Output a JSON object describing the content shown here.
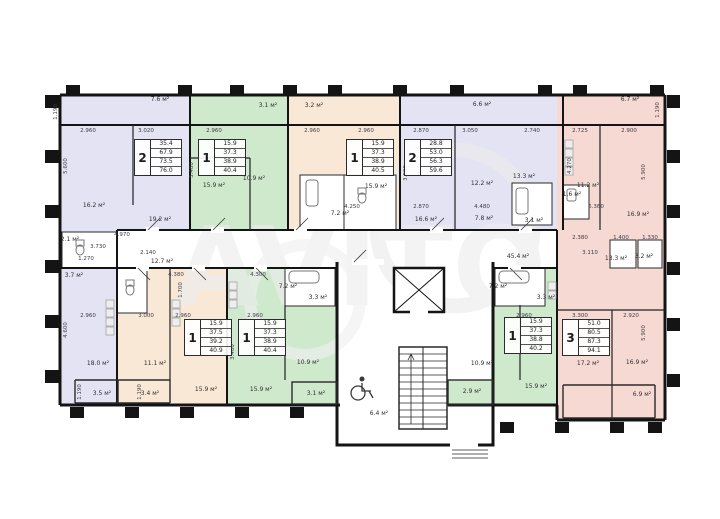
{
  "watermark": {
    "text": "AVITO"
  },
  "colors": {
    "lavender": "#e3e3f4",
    "green": "#cfe9cd",
    "peach": "#fae8d7",
    "pink": "#f7d9d3",
    "wall": "#141414",
    "dim_text": "#3c3c46",
    "watermark": "#ededed"
  },
  "apartments": [
    {
      "num": "2",
      "values": [
        "35.4",
        "67.9",
        "73.5",
        "76.0"
      ],
      "x": 134,
      "y": 139
    },
    {
      "num": "1",
      "values": [
        "15.9",
        "37.3",
        "38.9",
        "40.4"
      ],
      "x": 198,
      "y": 139
    },
    {
      "num": "1",
      "values": [
        "15.9",
        "37.3",
        "38.9",
        "40.5"
      ],
      "x": 346,
      "y": 139
    },
    {
      "num": "2",
      "values": [
        "28.8",
        "53.0",
        "56.3",
        "59.6"
      ],
      "x": 404,
      "y": 139
    },
    {
      "num": "1",
      "values": [
        "15.9",
        "37.5",
        "39.2",
        "40.9"
      ],
      "x": 184,
      "y": 319
    },
    {
      "num": "1",
      "values": [
        "15.9",
        "37.3",
        "38.9",
        "40.4"
      ],
      "x": 238,
      "y": 319
    },
    {
      "num": "1",
      "values": [
        "15.9",
        "37.3",
        "38.8",
        "40.2"
      ],
      "x": 504,
      "y": 317
    },
    {
      "num": "3",
      "values": [
        "51.0",
        "80.5",
        "87.3",
        "94.1"
      ],
      "x": 562,
      "y": 319
    }
  ],
  "area_labels": [
    {
      "t": "7.6 м²",
      "x": 160,
      "y": 100
    },
    {
      "t": "3.1 м²",
      "x": 268,
      "y": 106
    },
    {
      "t": "3.2 м²",
      "x": 314,
      "y": 106
    },
    {
      "t": "6.6 м²",
      "x": 482,
      "y": 105
    },
    {
      "t": "6.7 м²",
      "x": 630,
      "y": 100
    },
    {
      "t": "16.2 м²",
      "x": 94,
      "y": 206
    },
    {
      "t": "19.2 м²",
      "x": 160,
      "y": 220
    },
    {
      "t": "15.9 м²",
      "x": 214,
      "y": 186
    },
    {
      "t": "10.9 м²",
      "x": 254,
      "y": 179
    },
    {
      "t": "15.9 м²",
      "x": 376,
      "y": 187
    },
    {
      "t": "7.2 м²",
      "x": 340,
      "y": 214
    },
    {
      "t": "16.6 м²",
      "x": 426,
      "y": 220
    },
    {
      "t": "12.2 м²",
      "x": 482,
      "y": 184
    },
    {
      "t": "13.3 м²",
      "x": 524,
      "y": 177
    },
    {
      "t": "7.8 м²",
      "x": 484,
      "y": 219
    },
    {
      "t": "3.1 м²",
      "x": 534,
      "y": 221
    },
    {
      "t": "1.6 м²",
      "x": 572,
      "y": 195
    },
    {
      "t": "11.2 м²",
      "x": 588,
      "y": 186
    },
    {
      "t": "16.9 м²",
      "x": 638,
      "y": 215
    },
    {
      "t": "45.4 м²",
      "x": 518,
      "y": 257
    },
    {
      "t": "12.7 м²",
      "x": 162,
      "y": 262
    },
    {
      "t": "2.1 м²",
      "x": 70,
      "y": 240
    },
    {
      "t": "3.7 м²",
      "x": 74,
      "y": 276
    },
    {
      "t": "18.0 м²",
      "x": 98,
      "y": 364
    },
    {
      "t": "11.1 м²",
      "x": 155,
      "y": 364
    },
    {
      "t": "3.5 м²",
      "x": 102,
      "y": 394
    },
    {
      "t": "3.4 м²",
      "x": 150,
      "y": 394
    },
    {
      "t": "15.9 м²",
      "x": 206,
      "y": 390
    },
    {
      "t": "15.9 м²",
      "x": 261,
      "y": 390
    },
    {
      "t": "3.1 м²",
      "x": 316,
      "y": 394
    },
    {
      "t": "10.9 м²",
      "x": 308,
      "y": 363
    },
    {
      "t": "7.2 м²",
      "x": 288,
      "y": 287
    },
    {
      "t": "3.3 м²",
      "x": 318,
      "y": 298
    },
    {
      "t": "7.2 м²",
      "x": 498,
      "y": 287
    },
    {
      "t": "3.3 м²",
      "x": 546,
      "y": 298
    },
    {
      "t": "10.9 м²",
      "x": 482,
      "y": 364
    },
    {
      "t": "15.9 м²",
      "x": 536,
      "y": 387
    },
    {
      "t": "2.9 м²",
      "x": 472,
      "y": 392
    },
    {
      "t": "17.2 м²",
      "x": 588,
      "y": 364
    },
    {
      "t": "16.9 м²",
      "x": 637,
      "y": 363
    },
    {
      "t": "6.9 м²",
      "x": 642,
      "y": 395
    },
    {
      "t": "6.4 м²",
      "x": 379,
      "y": 414
    },
    {
      "t": "13.3 м²",
      "x": 616,
      "y": 259
    },
    {
      "t": "3.2 м²",
      "x": 644,
      "y": 257
    }
  ],
  "dimension_labels": [
    {
      "t": "2.960",
      "x": 88,
      "y": 131
    },
    {
      "t": "3.020",
      "x": 146,
      "y": 131
    },
    {
      "t": "2.960",
      "x": 214,
      "y": 131
    },
    {
      "t": "2.960",
      "x": 312,
      "y": 131
    },
    {
      "t": "2.960",
      "x": 366,
      "y": 131
    },
    {
      "t": "2.870",
      "x": 421,
      "y": 131
    },
    {
      "t": "3.050",
      "x": 470,
      "y": 131
    },
    {
      "t": "2.740",
      "x": 532,
      "y": 131
    },
    {
      "t": "2.725",
      "x": 580,
      "y": 131
    },
    {
      "t": "2.900",
      "x": 629,
      "y": 131
    },
    {
      "t": "4.250",
      "x": 352,
      "y": 207
    },
    {
      "t": "2.870",
      "x": 421,
      "y": 207
    },
    {
      "t": "4.480",
      "x": 482,
      "y": 207
    },
    {
      "t": "6.360",
      "x": 596,
      "y": 207
    },
    {
      "t": "4.970",
      "x": 122,
      "y": 235
    },
    {
      "t": "3.730",
      "x": 98,
      "y": 247
    },
    {
      "t": "2.140",
      "x": 148,
      "y": 253
    },
    {
      "t": "1.270",
      "x": 86,
      "y": 259
    },
    {
      "t": "2.380",
      "x": 580,
      "y": 238
    },
    {
      "t": "1.400",
      "x": 621,
      "y": 238
    },
    {
      "t": "1.330",
      "x": 650,
      "y": 238
    },
    {
      "t": "3.110",
      "x": 590,
      "y": 253
    },
    {
      "t": "4.380",
      "x": 176,
      "y": 275
    },
    {
      "t": "4.300",
      "x": 258,
      "y": 275
    },
    {
      "t": "2.960",
      "x": 88,
      "y": 316
    },
    {
      "t": "3.000",
      "x": 146,
      "y": 316
    },
    {
      "t": "2.960",
      "x": 183,
      "y": 316
    },
    {
      "t": "2.960",
      "x": 255,
      "y": 316
    },
    {
      "t": "2.960",
      "x": 524,
      "y": 316
    },
    {
      "t": "3.300",
      "x": 580,
      "y": 316
    },
    {
      "t": "2.920",
      "x": 631,
      "y": 316
    },
    {
      "t": "1.190",
      "x": 56,
      "y": 112,
      "r": 1
    },
    {
      "t": "5.600",
      "x": 66,
      "y": 166,
      "r": 1
    },
    {
      "t": "4.600",
      "x": 66,
      "y": 330,
      "r": 1
    },
    {
      "t": "5.480",
      "x": 192,
      "y": 170,
      "r": 1
    },
    {
      "t": "3.900",
      "x": 406,
      "y": 173,
      "r": 1
    },
    {
      "t": "4.270",
      "x": 570,
      "y": 166,
      "r": 1
    },
    {
      "t": "5.900",
      "x": 644,
      "y": 172,
      "r": 1
    },
    {
      "t": "1.700",
      "x": 181,
      "y": 290,
      "r": 1
    },
    {
      "t": "3.480",
      "x": 233,
      "y": 352,
      "r": 1
    },
    {
      "t": "5.900",
      "x": 644,
      "y": 333,
      "r": 1
    },
    {
      "t": "1.190",
      "x": 80,
      "y": 392,
      "r": 1
    },
    {
      "t": "1.190",
      "x": 140,
      "y": 392,
      "r": 1
    },
    {
      "t": "1.190",
      "x": 658,
      "y": 110,
      "r": 1
    }
  ]
}
